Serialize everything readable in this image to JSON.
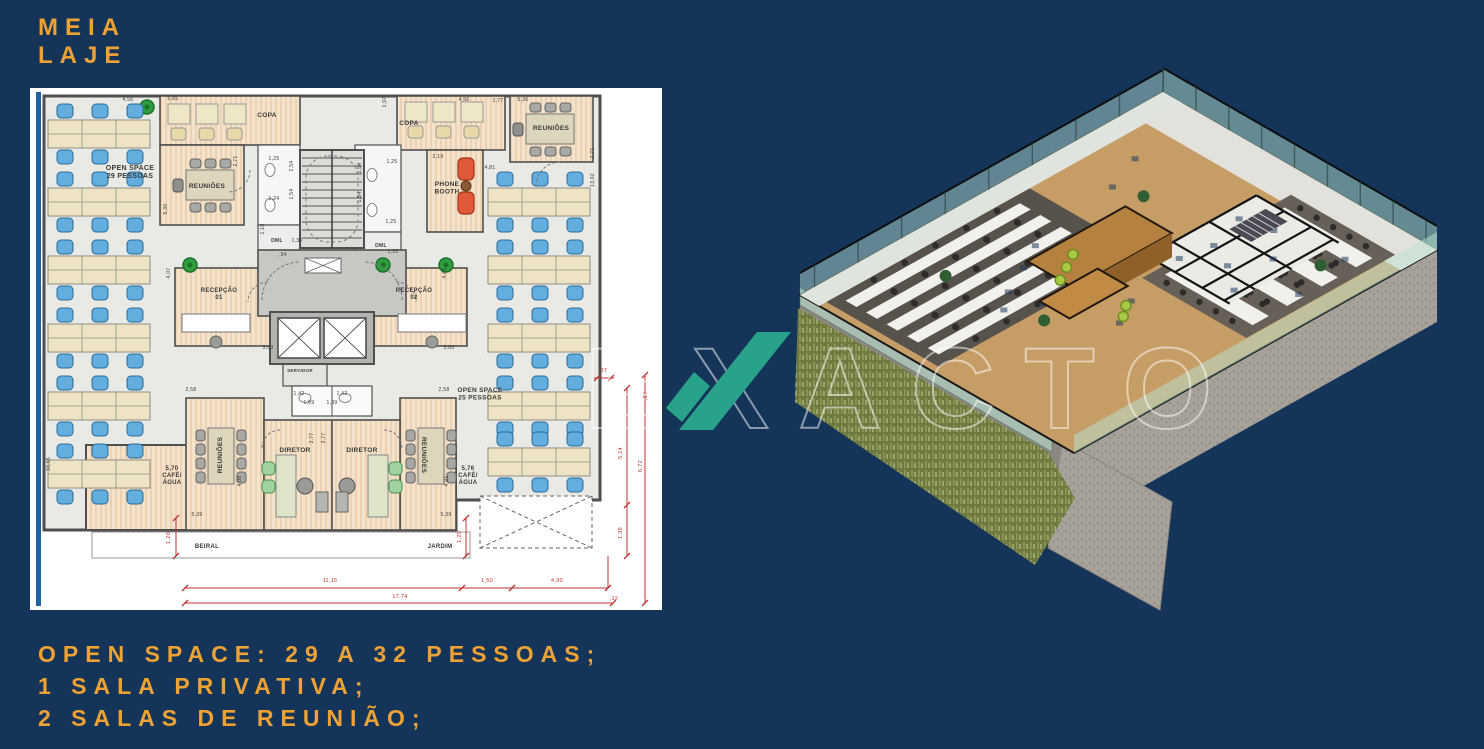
{
  "header": {
    "title": "MEIA LAJE"
  },
  "footer": {
    "lines": [
      "OPEN SPACE: 29 A 32 PESSOAS;",
      "1 SALA PRIVATIVA;",
      "2 SALAS DE REUNIÃO;"
    ]
  },
  "watermark": {
    "text": "EXACTO"
  },
  "colors": {
    "background": "#143459",
    "accent_gold": "#EDA233",
    "watermark_teal": "#28A38A",
    "sheet_edge_blue": "#2061A0",
    "plan_red": "#C23232",
    "chair_blue": "#62AEDE",
    "wood_room": "#F4E3CD",
    "open_floor": "#E9E9E6"
  },
  "floor_plan": {
    "room_labels": [
      {
        "lines": [
          "OPEN SPACE",
          "29 PESSOAS"
        ],
        "x": 130,
        "y": 170,
        "size": 7
      },
      {
        "lines": [
          "REUNIÕES"
        ],
        "x": 207,
        "y": 188,
        "size": 6.5
      },
      {
        "lines": [
          "COPA"
        ],
        "x": 267,
        "y": 117,
        "size": 6.5
      },
      {
        "lines": [
          "COPA"
        ],
        "x": 409,
        "y": 125,
        "size": 6.5
      },
      {
        "lines": [
          "PHONE",
          "BOOTH"
        ],
        "x": 447,
        "y": 186,
        "size": 6.5
      },
      {
        "lines": [
          "REUNIÕES"
        ],
        "x": 551,
        "y": 130,
        "size": 6.5
      },
      {
        "lines": [
          "RECEPÇÃO",
          "01"
        ],
        "x": 219,
        "y": 292,
        "size": 6
      },
      {
        "lines": [
          "RECEPÇÃO",
          "02"
        ],
        "x": 414,
        "y": 292,
        "size": 6
      },
      {
        "lines": [
          "SERVIDOR"
        ],
        "x": 300,
        "y": 372,
        "size": 4.5
      },
      {
        "lines": [
          "OPEN SPACE",
          "25 PESSOAS"
        ],
        "x": 480,
        "y": 392,
        "size": 6.5
      },
      {
        "lines": [
          "DIRETOR"
        ],
        "x": 295,
        "y": 452,
        "size": 6.5
      },
      {
        "lines": [
          "DIRETOR"
        ],
        "x": 362,
        "y": 452,
        "size": 6.5
      },
      {
        "lines": [
          "REUNIÕES"
        ],
        "x": 222,
        "y": 455,
        "size": 6.5,
        "rot": -90
      },
      {
        "lines": [
          "REUNIÕES"
        ],
        "x": 422,
        "y": 455,
        "size": 6.5,
        "rot": 90
      },
      {
        "lines": [
          "5,70",
          "CAFÉ/",
          "ÁGUA"
        ],
        "x": 172,
        "y": 470,
        "size": 6
      },
      {
        "lines": [
          "5,76",
          "CAFÉ/",
          "ÁGUA"
        ],
        "x": 468,
        "y": 470,
        "size": 6
      },
      {
        "lines": [
          "BEIRAL"
        ],
        "x": 207,
        "y": 548,
        "size": 6
      },
      {
        "lines": [
          "JARDIM"
        ],
        "x": 440,
        "y": 548,
        "size": 6
      },
      {
        "lines": [
          "DML"
        ],
        "x": 277,
        "y": 242,
        "size": 5
      },
      {
        "lines": [
          "DML"
        ],
        "x": 381,
        "y": 247,
        "size": 5
      }
    ],
    "dims_black": [
      {
        "t": "4,56",
        "x": 128,
        "y": 101
      },
      {
        "t": "5,85",
        "x": 173,
        "y": 100
      },
      {
        "t": "1,97",
        "x": 386,
        "y": 102,
        "r": -90
      },
      {
        "t": "4,56",
        "x": 464,
        "y": 101
      },
      {
        "t": "1,77",
        "x": 498,
        "y": 102
      },
      {
        "t": "5,36",
        "x": 523,
        "y": 101
      },
      {
        "t": "2,19",
        "x": 438,
        "y": 158
      },
      {
        "t": "4,81",
        "x": 490,
        "y": 169
      },
      {
        "t": "5,30",
        "x": 167,
        "y": 209,
        "r": -90
      },
      {
        "t": "2,71",
        "x": 237,
        "y": 161,
        "r": -90
      },
      {
        "t": "2,71",
        "x": 594,
        "y": 153,
        "r": -90
      },
      {
        "t": "13,62",
        "x": 594,
        "y": 180,
        "r": -90
      },
      {
        "t": "16,65",
        "x": 50,
        "y": 464,
        "r": -90
      },
      {
        "t": "3,63",
        "x": 268,
        "y": 349
      },
      {
        "t": "3,63",
        "x": 449,
        "y": 349
      },
      {
        "t": "2,58",
        "x": 191,
        "y": 391
      },
      {
        "t": "2,58",
        "x": 444,
        "y": 391
      },
      {
        "t": "4,07",
        "x": 170,
        "y": 273,
        "r": -90
      },
      {
        "t": "4,61",
        "x": 446,
        "y": 273,
        "r": -90
      },
      {
        "t": "1,42",
        "x": 299,
        "y": 395
      },
      {
        "t": "1,42",
        "x": 342,
        "y": 395
      },
      {
        "t": "1,89",
        "x": 309,
        "y": 404
      },
      {
        "t": "1,89",
        "x": 332,
        "y": 404
      },
      {
        "t": "3,77",
        "x": 313,
        "y": 438,
        "r": -90
      },
      {
        "t": "3,77",
        "x": 325,
        "y": 438,
        "r": -90
      },
      {
        "t": "4,08",
        "x": 241,
        "y": 481,
        "r": -90
      },
      {
        "t": "4,91",
        "x": 448,
        "y": 481,
        "r": -90
      },
      {
        "t": "5,39",
        "x": 197,
        "y": 516
      },
      {
        "t": "5,39",
        "x": 446,
        "y": 516
      },
      {
        "t": "1,25",
        "x": 274,
        "y": 160
      },
      {
        "t": "1,54",
        "x": 293,
        "y": 166,
        "r": -90
      },
      {
        "t": "1,54",
        "x": 293,
        "y": 194,
        "r": -90
      },
      {
        "t": "1,24",
        "x": 274,
        "y": 200
      },
      {
        "t": "1,25",
        "x": 392,
        "y": 163
      },
      {
        "t": "1,54",
        "x": 361,
        "y": 168,
        "r": -90
      },
      {
        "t": "1,54",
        "x": 361,
        "y": 197,
        "r": -90
      },
      {
        "t": "1,25",
        "x": 391,
        "y": 223
      },
      {
        "t": "1,10",
        "x": 264,
        "y": 229,
        "r": -90
      },
      {
        "t": "1,30",
        "x": 297,
        "y": 242
      },
      {
        "t": ",94",
        "x": 283,
        "y": 256
      },
      {
        "t": "1,35",
        "x": 393,
        "y": 253
      }
    ],
    "dims_red": [
      {
        "t": "1,20",
        "x": 170,
        "y": 538,
        "r": -90
      },
      {
        "t": "1,20",
        "x": 461,
        "y": 537,
        "r": -90
      },
      {
        "t": "11,15",
        "x": 330,
        "y": 582
      },
      {
        "t": "1,50",
        "x": 487,
        "y": 582
      },
      {
        "t": "4,90",
        "x": 557,
        "y": 582
      },
      {
        "t": "17,74",
        "x": 400,
        "y": 598
      },
      {
        "t": ",12",
        "x": 614,
        "y": 600
      },
      {
        "t": "5,14",
        "x": 622,
        "y": 453,
        "r": -90
      },
      {
        "t": "6,72",
        "x": 642,
        "y": 466,
        "r": -90
      },
      {
        "t": "1,39",
        "x": 622,
        "y": 533,
        "r": -90
      },
      {
        "t": ",37",
        "x": 603,
        "y": 372
      },
      {
        "t": ",19",
        "x": 647,
        "y": 396,
        "r": -90
      }
    ]
  }
}
